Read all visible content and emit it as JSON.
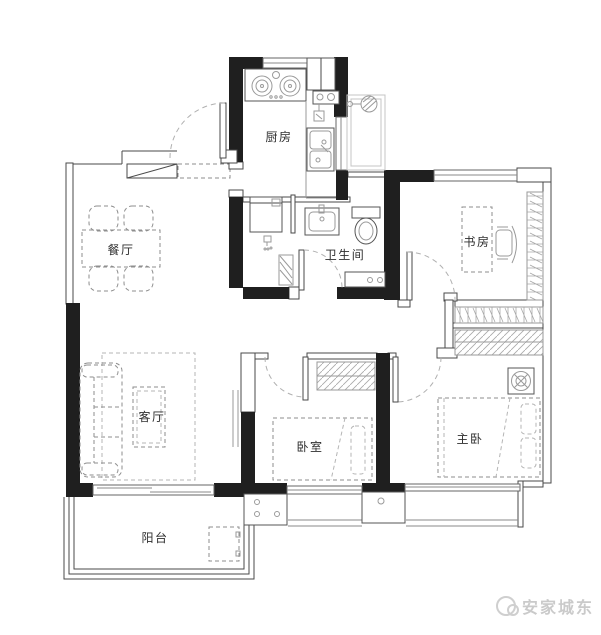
{
  "rooms": {
    "kitchen": {
      "label": "厨房"
    },
    "dining": {
      "label": "餐厅"
    },
    "bathroom": {
      "label": "卫生间"
    },
    "study": {
      "label": "书房"
    },
    "living": {
      "label": "客厅"
    },
    "bedroom": {
      "label": "卧室"
    },
    "master_bedroom": {
      "label": "主卧"
    },
    "balcony": {
      "label": "阳台"
    }
  },
  "watermark": {
    "icon": "swirl-badge-icon",
    "text": "安家城东",
    "color": "#cacaca"
  },
  "colors": {
    "wall": "#1f1f1f",
    "outline": "#4a4a4a",
    "furniture_dash": "#8e8e8e",
    "light_gray": "#c4c4c4",
    "label": "#2e2e2e"
  }
}
